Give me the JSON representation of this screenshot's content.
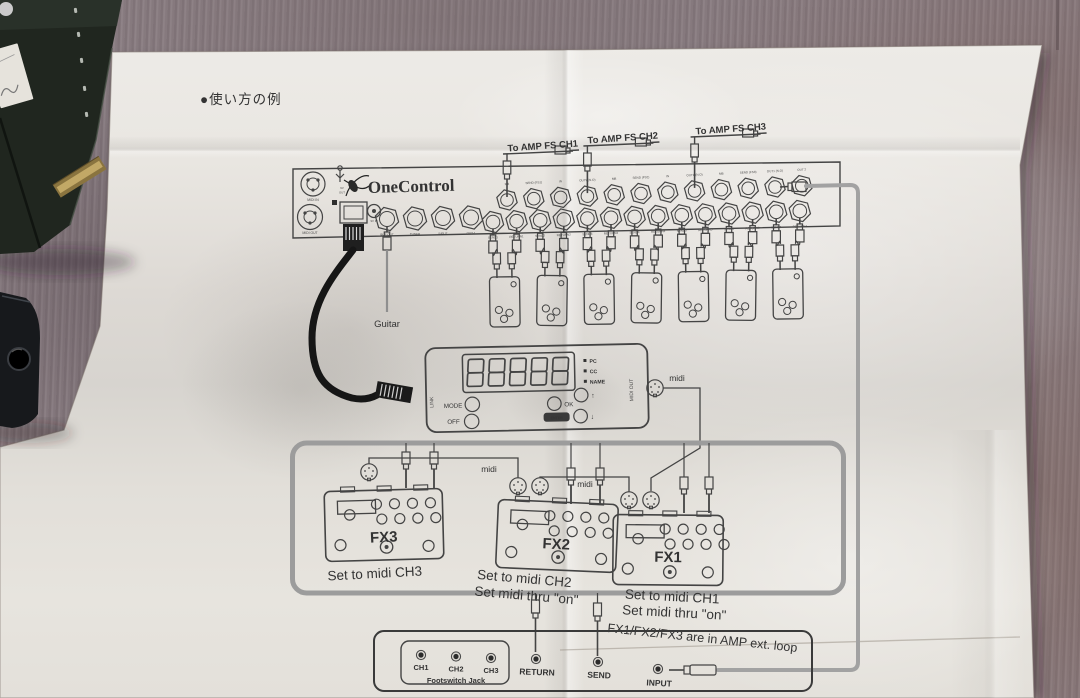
{
  "photo": {
    "header_note": "●使い方の例",
    "ink_color": "#3c3c3c",
    "paper_color": "#e8e5e0",
    "carpet_color": "#8c8085",
    "cable_gray": "#a2a2a2",
    "link_cable_black": "#1a1a1a"
  },
  "unit": {
    "brand": "OneControl",
    "midi_in_label": "MIDI IN",
    "midi_out_label": "MIDI OUT",
    "power_labels": [
      "9V",
      "OUT"
    ],
    "dc_label": "9V IN",
    "left_jack_labels": [
      "BUF OUT",
      "TUNER",
      "INPUT",
      "OUT-1"
    ],
    "top_jack_labels": [
      "MB",
      "SEND (FS1)",
      "IN",
      "OUT9 (N.O)",
      "MB",
      "SEND (FS2)",
      "IN",
      "OUT9 (N.O)",
      "MB",
      "SEND (FS3)",
      "OUT1 (N.O)",
      "OUT 2"
    ],
    "loop_jack_labels": [
      "SEND1",
      "RETURN1",
      "SEND2",
      "RETURN2",
      "SEND3",
      "RETURN3",
      "SEND4",
      "RETURN4",
      "SEND5",
      "RETURN5",
      "SEND6",
      "RETURN6",
      "SEND7",
      "RETURN7"
    ]
  },
  "amp_fs_labels": [
    "To AMP FS CH1",
    "To AMP FS CH2",
    "To AMP FS CH3"
  ],
  "guitar_label": "Guitar",
  "controller": {
    "link_label": "LINK",
    "display_digits": "88888",
    "indicators": [
      "PC",
      "CC",
      "NAME"
    ],
    "mode_label": "MODE",
    "off_label": "OFF",
    "ok_label": "OK",
    "enter_label": "ENTER",
    "up_label": "↑",
    "down_label": "↓",
    "midi_out_label": "MIDI OUT"
  },
  "midi_labels": [
    "midi",
    "midi",
    "midi"
  ],
  "fx_pedals": [
    {
      "name": "FX3",
      "caption1": "Set to midi CH3"
    },
    {
      "name": "FX2",
      "caption1": "Set to midi CH2",
      "caption2": "Set midi thru \"on\""
    },
    {
      "name": "FX1",
      "caption1": "Set to midi CH1",
      "caption2": "Set midi thru \"on\""
    }
  ],
  "loop_note": "FX1/FX2/FX3 are in AMP ext. loop",
  "amp_panel": {
    "channels": [
      "CH1",
      "CH2",
      "CH3"
    ],
    "footswitch_label": "Footswitch Jack",
    "return_label": "RETURN",
    "send_label": "SEND",
    "input_label": "INPUT"
  }
}
